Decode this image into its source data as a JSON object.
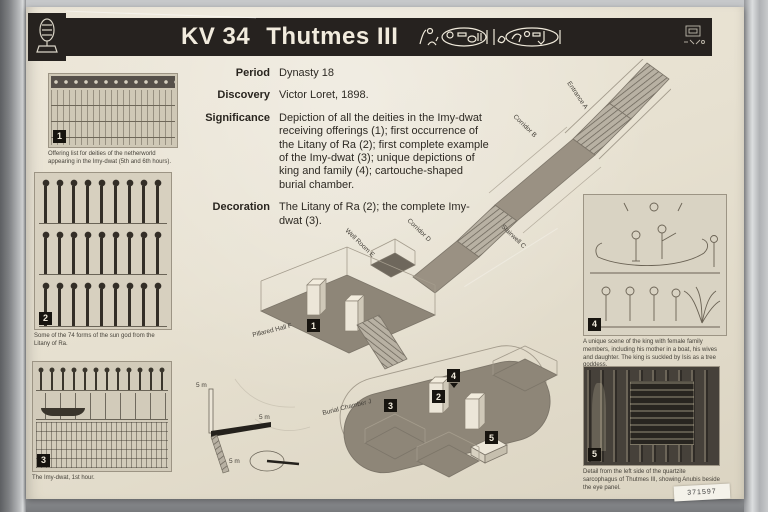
{
  "header": {
    "tomb_number": "KV 34",
    "tomb_name": "Thutmes III"
  },
  "info": {
    "period_label": "Period",
    "period_value": "Dynasty 18",
    "discovery_label": "Discovery",
    "discovery_value": "Victor Loret, 1898.",
    "significance_label": "Significance",
    "significance_value": "Depiction of all the deities in the Imy-dwat receiving offerings (1); first occurrence of the Litany of Ra (2); first complete example of the Imy-dwat (3); unique depictions of king and family (4); cartouche-shaped burial chamber.",
    "decoration_label": "Decoration",
    "decoration_value": "The Litany of Ra (2); the complete Imy-dwat (3)."
  },
  "figures": {
    "fig1": {
      "number": "1",
      "caption": "Offering list for deities of the netherworld appearing in the Imy-dwat (5th and 6th hours)."
    },
    "fig2": {
      "number": "2",
      "caption": "Some of the 74 forms of the sun god from the Litany of Ra."
    },
    "fig3": {
      "number": "3",
      "caption": "The Imy-dwat, 1st hour."
    },
    "fig4": {
      "number": "4",
      "caption": "A unique scene of the king with female family members, including his mother in a boat, his wives and daughter. The king is suckled by Isis as a tree goddess."
    },
    "fig5": {
      "number": "5",
      "caption": "Detail from the left side of the quartzite sarcophagus of Thutmes III, showing Anubis beside the eye panel."
    }
  },
  "diagram": {
    "labels": {
      "entrance": "Entrance A",
      "corridor_b": "Corridor B",
      "stairwell_c": "Stairwell C",
      "corridor_d": "Corridor D",
      "well_room": "Well Room E",
      "pillared_hall": "Pillared Hall F",
      "burial_chamber": "Burial Chamber J"
    },
    "markers": {
      "m1": "1",
      "m2": "2",
      "m3": "3",
      "m4": "4",
      "m5": "5"
    },
    "scale_label": "5 m"
  },
  "sticker": {
    "number": "371597"
  }
}
